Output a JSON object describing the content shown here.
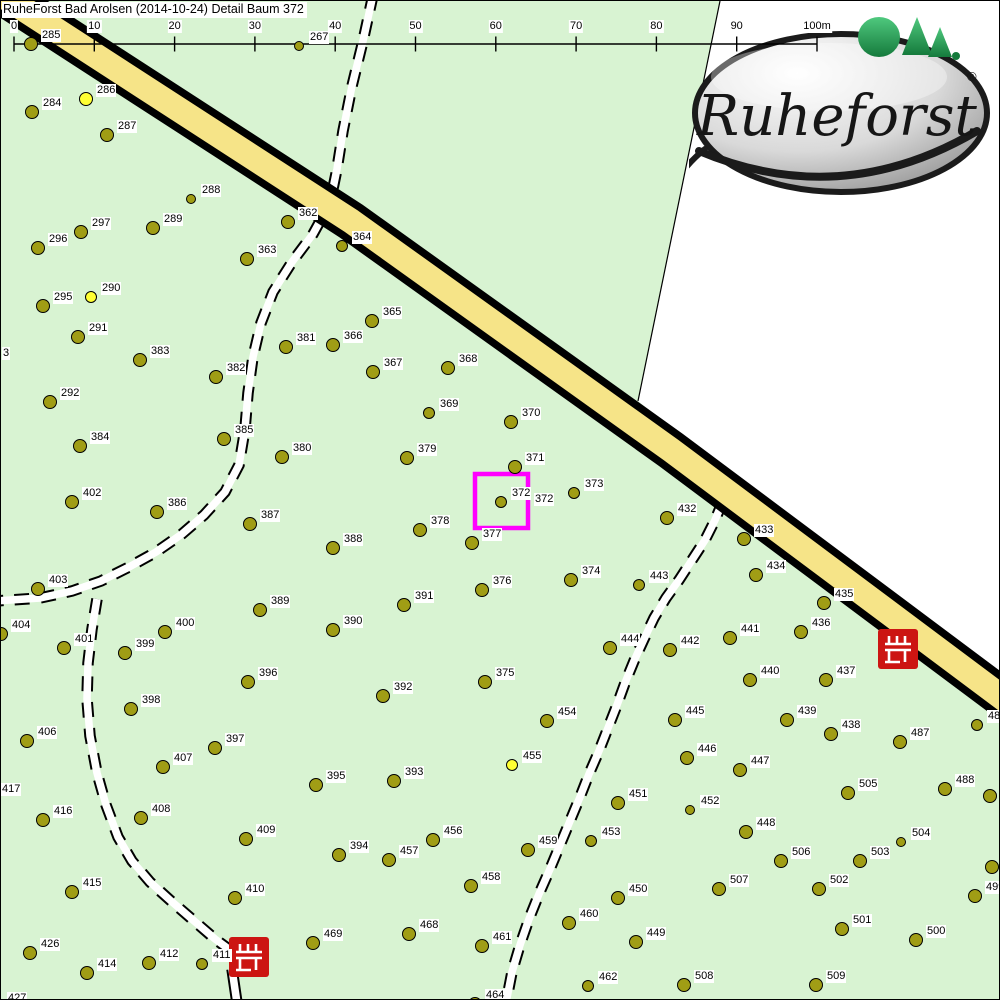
{
  "title": "RuheForst Bad Arolsen (2014-10-24) Detail  Baum 372",
  "logo": {
    "name": "Ruheforst",
    "reg": "®"
  },
  "scale_bar": {
    "labels": [
      "0",
      "10",
      "20",
      "30",
      "40",
      "50",
      "60",
      "70",
      "80",
      "90",
      "100m"
    ],
    "x_start": 13,
    "spacing": 80.3,
    "y": 43
  },
  "highlight": {
    "tree": "372",
    "x": 474,
    "y": 473,
    "w": 53,
    "h": 54
  },
  "colors": {
    "map_green": "#d8f3d2",
    "road_yellow": "#f6e488",
    "tree_olive": "#a09d15",
    "tree_yellow": "#ffff33",
    "bench_red": "#cc1512",
    "highlight": "#ff00ff"
  },
  "benches": [
    {
      "x": 897,
      "y": 648
    },
    {
      "x": 248,
      "y": 956
    }
  ],
  "geometry": {
    "white_area": "719,0 1001,0 1001,690 637,400",
    "boundary": {
      "x1": 719,
      "y1": 0,
      "x2": 637,
      "y2": 400
    },
    "road": "-30,-26 350,220 670,449 1030,718",
    "trails": [
      {
        "name": "trail-north-west",
        "dashed": true,
        "pts": "372,-6 362,40 351,85 342,130 336,168 329,202 312,233 291,261 272,291 260,322 252,356 247,392 244,428 238,464 224,491 203,514 181,533 155,551 128,566 100,580 71,590 39,597 -6,600"
      },
      {
        "name": "trail-south-branch",
        "dashed": true,
        "pts": "96,598 91,628 87,662 86,698 89,735 96,772 105,804 117,836 131,860 149,881 170,900 192,919 214,938 229,949"
      },
      {
        "name": "trail-stub-below-bench",
        "dashed": false,
        "pts": "231,968 236,1002"
      },
      {
        "name": "trail-east",
        "dashed": true,
        "pts": "722,500 714,519 704,539 691,559 678,579 665,597 653,617 643,638 633,660 624,682 616,704 607,727 598,750 588,773 579,796 569,820 559,844 549,868 538,893 528,918 519,944 511,971 505,1002"
      }
    ]
  },
  "trees": [
    {
      "n": "285",
      "x": 29,
      "y": 42
    },
    {
      "n": "267",
      "x": 297,
      "y": 44,
      "r": 4
    },
    {
      "n": "286",
      "x": 84,
      "y": 97,
      "c": "y"
    },
    {
      "n": "284",
      "x": 30,
      "y": 110
    },
    {
      "n": "287",
      "x": 105,
      "y": 133
    },
    {
      "n": "288",
      "x": 189,
      "y": 197,
      "r": 4
    },
    {
      "n": "362",
      "x": 286,
      "y": 220
    },
    {
      "n": "289",
      "x": 151,
      "y": 226
    },
    {
      "n": "297",
      "x": 79,
      "y": 230
    },
    {
      "n": "296",
      "x": 36,
      "y": 246
    },
    {
      "n": "363",
      "x": 245,
      "y": 257
    },
    {
      "n": "364",
      "x": 340,
      "y": 244,
      "r": 5
    },
    {
      "n": "290",
      "x": 89,
      "y": 295,
      "c": "y",
      "r": 5
    },
    {
      "n": "295",
      "x": 41,
      "y": 304
    },
    {
      "n": "365",
      "x": 370,
      "y": 319
    },
    {
      "n": "291",
      "x": 76,
      "y": 335
    },
    {
      "n": "366",
      "x": 331,
      "y": 343
    },
    {
      "n": "381",
      "x": 284,
      "y": 345
    },
    {
      "n": "383",
      "x": 138,
      "y": 358
    },
    {
      "n": "368",
      "x": 446,
      "y": 366
    },
    {
      "n": "367",
      "x": 371,
      "y": 370
    },
    {
      "n": "382",
      "x": 214,
      "y": 375
    },
    {
      "n": "292",
      "x": 48,
      "y": 400
    },
    {
      "n": "369",
      "x": 427,
      "y": 411,
      "r": 5
    },
    {
      "n": "370",
      "x": 509,
      "y": 420
    },
    {
      "n": "385",
      "x": 222,
      "y": 437
    },
    {
      "n": "384",
      "x": 78,
      "y": 444
    },
    {
      "n": "380",
      "x": 280,
      "y": 455
    },
    {
      "n": "379",
      "x": 405,
      "y": 456
    },
    {
      "n": "371",
      "x": 513,
      "y": 465
    },
    {
      "n": "373",
      "x": 572,
      "y": 491,
      "r": 5
    },
    {
      "n": "372",
      "x": 499,
      "y": 500,
      "r": 5
    },
    {
      "n": "402",
      "x": 70,
      "y": 500
    },
    {
      "n": "386",
      "x": 155,
      "y": 510
    },
    {
      "n": "432",
      "x": 665,
      "y": 516
    },
    {
      "n": "387",
      "x": 248,
      "y": 522
    },
    {
      "n": "378",
      "x": 418,
      "y": 528
    },
    {
      "n": "433",
      "x": 742,
      "y": 537
    },
    {
      "n": "377",
      "x": 470,
      "y": 541
    },
    {
      "n": "388",
      "x": 331,
      "y": 546
    },
    {
      "n": "434",
      "x": 754,
      "y": 573
    },
    {
      "n": "374",
      "x": 569,
      "y": 578
    },
    {
      "n": "443",
      "x": 637,
      "y": 583,
      "r": 5
    },
    {
      "n": "403",
      "x": 36,
      "y": 587
    },
    {
      "n": "376",
      "x": 480,
      "y": 588
    },
    {
      "n": "435",
      "x": 822,
      "y": 601
    },
    {
      "n": "391",
      "x": 402,
      "y": 603
    },
    {
      "n": "389",
      "x": 258,
      "y": 608
    },
    {
      "n": "390",
      "x": 331,
      "y": 628
    },
    {
      "n": "400",
      "x": 163,
      "y": 630
    },
    {
      "n": "436",
      "x": 799,
      "y": 630
    },
    {
      "n": "404",
      "x": -1,
      "y": 632
    },
    {
      "n": "441",
      "x": 728,
      "y": 636
    },
    {
      "n": "401",
      "x": 62,
      "y": 646
    },
    {
      "n": "444",
      "x": 608,
      "y": 646
    },
    {
      "n": "442",
      "x": 668,
      "y": 648
    },
    {
      "n": "399",
      "x": 123,
      "y": 651
    },
    {
      "n": "375",
      "x": 483,
      "y": 680
    },
    {
      "n": "396",
      "x": 246,
      "y": 680
    },
    {
      "n": "440",
      "x": 748,
      "y": 678
    },
    {
      "n": "437",
      "x": 824,
      "y": 678
    },
    {
      "n": "392",
      "x": 381,
      "y": 694
    },
    {
      "n": "398",
      "x": 129,
      "y": 707
    },
    {
      "n": "445",
      "x": 673,
      "y": 718
    },
    {
      "n": "439",
      "x": 785,
      "y": 718
    },
    {
      "n": "454",
      "x": 545,
      "y": 719
    },
    {
      "n": "486",
      "x": 975,
      "y": 723,
      "r": 5
    },
    {
      "n": "438",
      "x": 829,
      "y": 732
    },
    {
      "n": "406",
      "x": 25,
      "y": 739
    },
    {
      "n": "487",
      "x": 898,
      "y": 740
    },
    {
      "n": "397",
      "x": 213,
      "y": 746
    },
    {
      "n": "446",
      "x": 685,
      "y": 756
    },
    {
      "n": "455",
      "x": 510,
      "y": 763,
      "c": "y",
      "r": 5
    },
    {
      "n": "407",
      "x": 161,
      "y": 765
    },
    {
      "n": "447",
      "x": 738,
      "y": 768
    },
    {
      "n": "393",
      "x": 392,
      "y": 779
    },
    {
      "n": "395",
      "x": 314,
      "y": 783
    },
    {
      "n": "488",
      "x": 943,
      "y": 787
    },
    {
      "n": "505",
      "x": 846,
      "y": 791
    },
    {
      "n": "",
      "x": 988,
      "y": 794
    },
    {
      "n": "451",
      "x": 616,
      "y": 801
    },
    {
      "n": "452",
      "x": 688,
      "y": 808,
      "r": 4
    },
    {
      "n": "408",
      "x": 139,
      "y": 816
    },
    {
      "n": "416",
      "x": 41,
      "y": 818
    },
    {
      "n": "448",
      "x": 744,
      "y": 830
    },
    {
      "n": "409",
      "x": 244,
      "y": 837
    },
    {
      "n": "456",
      "x": 431,
      "y": 838
    },
    {
      "n": "453",
      "x": 589,
      "y": 839,
      "r": 5
    },
    {
      "n": "504",
      "x": 899,
      "y": 840,
      "r": 4
    },
    {
      "n": "459",
      "x": 526,
      "y": 848
    },
    {
      "n": "394",
      "x": 337,
      "y": 853
    },
    {
      "n": "457",
      "x": 387,
      "y": 858
    },
    {
      "n": "506",
      "x": 779,
      "y": 859
    },
    {
      "n": "503",
      "x": 858,
      "y": 859
    },
    {
      "n": "",
      "x": 990,
      "y": 865
    },
    {
      "n": "458",
      "x": 469,
      "y": 884
    },
    {
      "n": "507",
      "x": 717,
      "y": 887
    },
    {
      "n": "502",
      "x": 817,
      "y": 887
    },
    {
      "n": "415",
      "x": 70,
      "y": 890
    },
    {
      "n": "499",
      "x": 973,
      "y": 894
    },
    {
      "n": "450",
      "x": 616,
      "y": 896
    },
    {
      "n": "410",
      "x": 233,
      "y": 896
    },
    {
      "n": "460",
      "x": 567,
      "y": 921
    },
    {
      "n": "501",
      "x": 840,
      "y": 927
    },
    {
      "n": "468",
      "x": 407,
      "y": 932
    },
    {
      "n": "500",
      "x": 914,
      "y": 938
    },
    {
      "n": "449",
      "x": 634,
      "y": 940
    },
    {
      "n": "469",
      "x": 311,
      "y": 941
    },
    {
      "n": "461",
      "x": 480,
      "y": 944
    },
    {
      "n": "426",
      "x": 28,
      "y": 951
    },
    {
      "n": "412",
      "x": 147,
      "y": 961
    },
    {
      "n": "411",
      "x": 200,
      "y": 962,
      "r": 5
    },
    {
      "n": "414",
      "x": 85,
      "y": 971
    },
    {
      "n": "508",
      "x": 682,
      "y": 983
    },
    {
      "n": "509",
      "x": 814,
      "y": 983
    },
    {
      "n": "462",
      "x": 586,
      "y": 984,
      "r": 5
    },
    {
      "n": "464",
      "x": 473,
      "y": 1002
    }
  ],
  "extra_labels": [
    {
      "t": "3",
      "x": 1,
      "y": 346
    },
    {
      "t": "417",
      "x": 0,
      "y": 782
    },
    {
      "t": "427",
      "x": 6,
      "y": 991
    },
    {
      "t": "372",
      "x": 533,
      "y": 492
    }
  ]
}
